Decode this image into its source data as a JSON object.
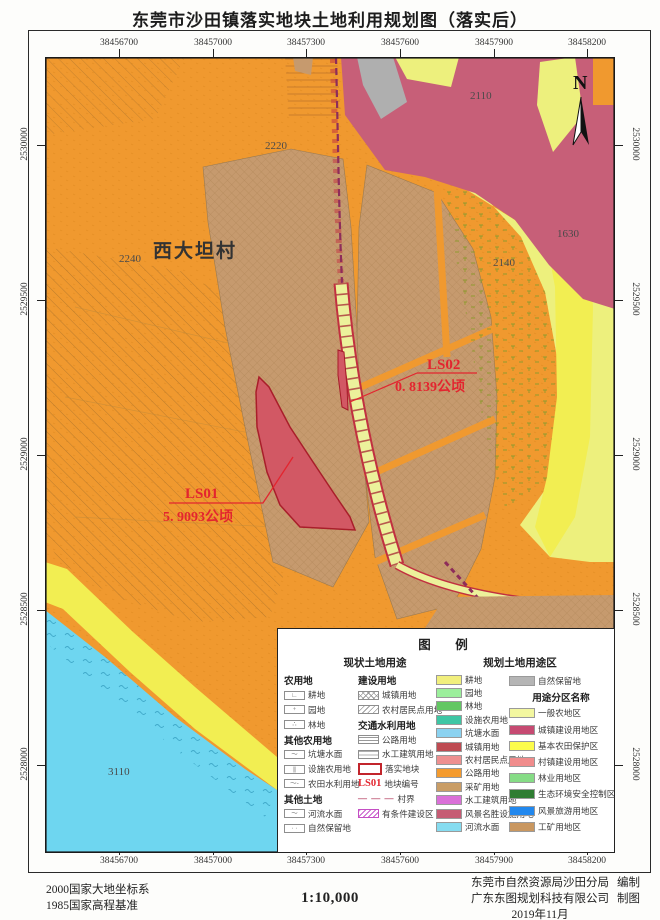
{
  "title": "东莞市沙田镇落实地块土地利用规划图（落实后）",
  "map": {
    "x_labels": [
      "38456700",
      "38457000",
      "38457300",
      "38457600",
      "38457900",
      "38458200"
    ],
    "y_labels": [
      "2530000",
      "2529500",
      "2529000",
      "2528500",
      "2528000"
    ],
    "north": "N",
    "village": "西大坦村",
    "area_codes": [
      "2110",
      "2220",
      "2240",
      "2140",
      "1630",
      "3110"
    ],
    "plots": [
      {
        "id": "LS01",
        "area": "5. 9093公顷"
      },
      {
        "id": "LS02",
        "area": "0. 8139公顷"
      }
    ]
  },
  "legend": {
    "title": "图　例",
    "section_current": "现状土地用途",
    "section_planned": "规划土地用途区",
    "col1": [
      {
        "t": "h",
        "label": "农用地"
      },
      {
        "t": "s",
        "label": "耕地",
        "sw": {
          "sym": "∟"
        }
      },
      {
        "t": "s",
        "label": "园地",
        "sw": {
          "sym": "+"
        }
      },
      {
        "t": "s",
        "label": "林地",
        "sw": {
          "sym": "∴"
        }
      },
      {
        "t": "h",
        "label": "其他农用地"
      },
      {
        "t": "s",
        "label": "坑塘水面",
        "sw": {
          "sym": "～"
        }
      },
      {
        "t": "s",
        "label": "设施农用地",
        "sw": {
          "sym": "|||"
        }
      },
      {
        "t": "s",
        "label": "农田水利用地",
        "sw": {
          "sym": "～-"
        }
      },
      {
        "t": "h",
        "label": "其他土地"
      },
      {
        "t": "s",
        "label": "河流水面",
        "sw": {
          "sym": "～"
        }
      },
      {
        "t": "s",
        "label": "自然保留地",
        "sw": {
          "sym": "· ·"
        }
      }
    ],
    "col2": [
      {
        "t": "h",
        "label": "建设用地"
      },
      {
        "t": "s",
        "label": "城镇用地",
        "sw": {
          "pattern": "cross"
        }
      },
      {
        "t": "s",
        "label": "农村居民点用地",
        "sw": {
          "pattern": "diag"
        }
      },
      {
        "t": "h",
        "label": "交通水利用地"
      },
      {
        "t": "s",
        "label": "公路用地",
        "sw": {
          "pattern": "hl"
        }
      },
      {
        "t": "s",
        "label": "水工建筑用地",
        "sw": {
          "pattern": "hd"
        }
      },
      {
        "t": "s",
        "label": "落实地块",
        "sw": {
          "redbox": true
        }
      },
      {
        "t": "s",
        "label": "地块编号",
        "sw": {
          "text": "LS01"
        }
      },
      {
        "t": "s",
        "label": "村界",
        "sw": {
          "dashes": true
        }
      },
      {
        "t": "s",
        "label": "有条件建设区",
        "sw": {
          "pattern": "zz"
        }
      }
    ],
    "col3": [
      {
        "t": "s",
        "label": "耕地",
        "sw": {
          "fill": "#F1EF7D"
        }
      },
      {
        "t": "s",
        "label": "园地",
        "sw": {
          "fill": "#9CEF9C"
        }
      },
      {
        "t": "s",
        "label": "林地",
        "sw": {
          "fill": "#63C763"
        }
      },
      {
        "t": "s",
        "label": "设施农用地",
        "sw": {
          "fill": "#3EC6A4"
        }
      },
      {
        "t": "s",
        "label": "坑塘水面",
        "sw": {
          "fill": "#8BD2F0"
        }
      },
      {
        "t": "s",
        "label": "城镇用地",
        "sw": {
          "fill": "#BE4B52"
        }
      },
      {
        "t": "s",
        "label": "农村居民点用地",
        "sw": {
          "fill": "#EE9090"
        }
      },
      {
        "t": "s",
        "label": "公路用地",
        "sw": {
          "fill": "#F49B2E"
        }
      },
      {
        "t": "s",
        "label": "采矿用地",
        "sw": {
          "fill": "#C99D66"
        }
      },
      {
        "t": "s",
        "label": "水工建筑用地",
        "sw": {
          "fill": "#DA70D8"
        }
      },
      {
        "t": "s",
        "label": "风景名胜设施用地",
        "sw": {
          "fill": "#C65C74"
        }
      },
      {
        "t": "s",
        "label": "河流水面",
        "sw": {
          "fill": "#86DCF0"
        }
      }
    ],
    "col4": [
      {
        "t": "s",
        "label": "自然保留地",
        "sw": {
          "fill": "#B5B5B5"
        }
      },
      {
        "t": "h",
        "label": "用途分区名称"
      },
      {
        "t": "s",
        "label": "一般农地区",
        "sw": {
          "fill": "#F3F7A0"
        }
      },
      {
        "t": "s",
        "label": "城镇建设用地区",
        "sw": {
          "fill": "#C64A72"
        }
      },
      {
        "t": "s",
        "label": "基本农田保护区",
        "sw": {
          "fill": "#FCFC4B",
          "black": true
        }
      },
      {
        "t": "s",
        "label": "村镇建设用地区",
        "sw": {
          "fill": "#F08C8C"
        }
      },
      {
        "t": "s",
        "label": "林业用地区",
        "sw": {
          "fill": "#86DC86"
        }
      },
      {
        "t": "s",
        "label": "生态环境安全控制区",
        "sw": {
          "fill": "#2F7D32"
        }
      },
      {
        "t": "s",
        "label": "风景旅游用地区",
        "sw": {
          "fill": "#2288EE"
        }
      },
      {
        "t": "s",
        "label": "工矿用地区",
        "sw": {
          "fill": "#C99760"
        }
      }
    ]
  },
  "footer": {
    "datum_line1": "2000国家大地坐标系",
    "datum_line2": "1985国家高程基准",
    "scale": "1:10,000",
    "credits": [
      {
        "org": "东莞市自然资源局沙田分局",
        "role": "编制"
      },
      {
        "org": "广东东图规划科技有限公司",
        "role": "制图"
      }
    ],
    "date": "2019年11月"
  },
  "colors": {
    "base_orange": "#F0992F",
    "parcel_tan": "#C69A6E",
    "town_pink": "#C75F78",
    "farm_yellow": "#EDF07D",
    "bright_yellow": "#F2EE52",
    "water_cyan": "#6ED6F0",
    "reserve_gray": "#AFAFAF",
    "plot_red": "#D25864",
    "annotation_red": "#E3252F",
    "village_boundary": "#8E2C5A"
  }
}
